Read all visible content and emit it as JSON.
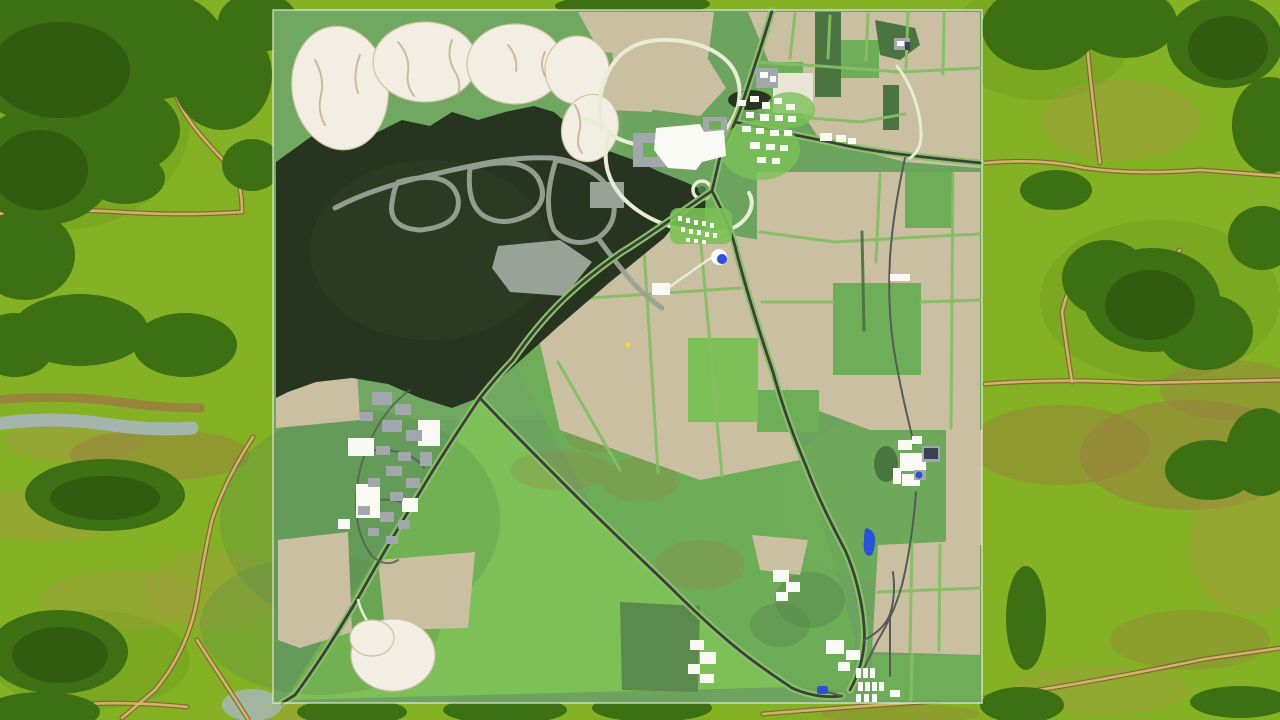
{
  "scene": {
    "type": "game-map-overview",
    "style": "Top-down farming-game map preview centered over an aerial meadow backdrop",
    "map_features": [
      "gravel quarry",
      "pine forest with trails",
      "hilltop village",
      "factory yard",
      "allotment campsite",
      "industrial estate",
      "crop fields",
      "pastures",
      "east farmstead",
      "south farmstead",
      "sand pit",
      "ponds",
      "road network"
    ],
    "background_features": [
      "meadow",
      "tree clusters",
      "dirt tracks",
      "stream"
    ]
  },
  "palette": {
    "bg_meadow": "#85b224",
    "bg_meadow_deep": "#6f9d1d",
    "bg_olive": "#a39a42",
    "bg_brown": "#9b7b40",
    "bg_tree": "#3c7013",
    "bg_tree_dark": "#2c530d",
    "bg_path": "#d3b269",
    "bg_path_edge": "#7d6434",
    "bg_water": "#a4b6ac",
    "map_base": "#6ba35f",
    "map_tl_grass": "#73ab63",
    "map_grass_bright": "#7cc057",
    "map_grass_mid": "#6fae58",
    "map_grass_deep": "#5b8a4c",
    "map_field": "#cbbfa2",
    "map_field_light": "#e9e6d6",
    "map_forest": "#263420",
    "map_trees": "#4a7440",
    "map_trail": "#99a296",
    "map_quarry": "#f2eee3",
    "map_quarry_streak": "#bfae8e",
    "map_divider": "#86bd65",
    "map_hedge": "#48703e",
    "map_road": "#3a403a",
    "map_road_verge": "#8ac168",
    "map_road_minor": "#565c55",
    "map_path_light": "#e7edd5",
    "building_white": "#fafaf4",
    "building_gray": "#a2a7ac",
    "solar_panel": "#3a4354",
    "water_blue": "#2b52d6",
    "marker_yellow": "#e6e03e",
    "map_border": "#eef3de"
  }
}
